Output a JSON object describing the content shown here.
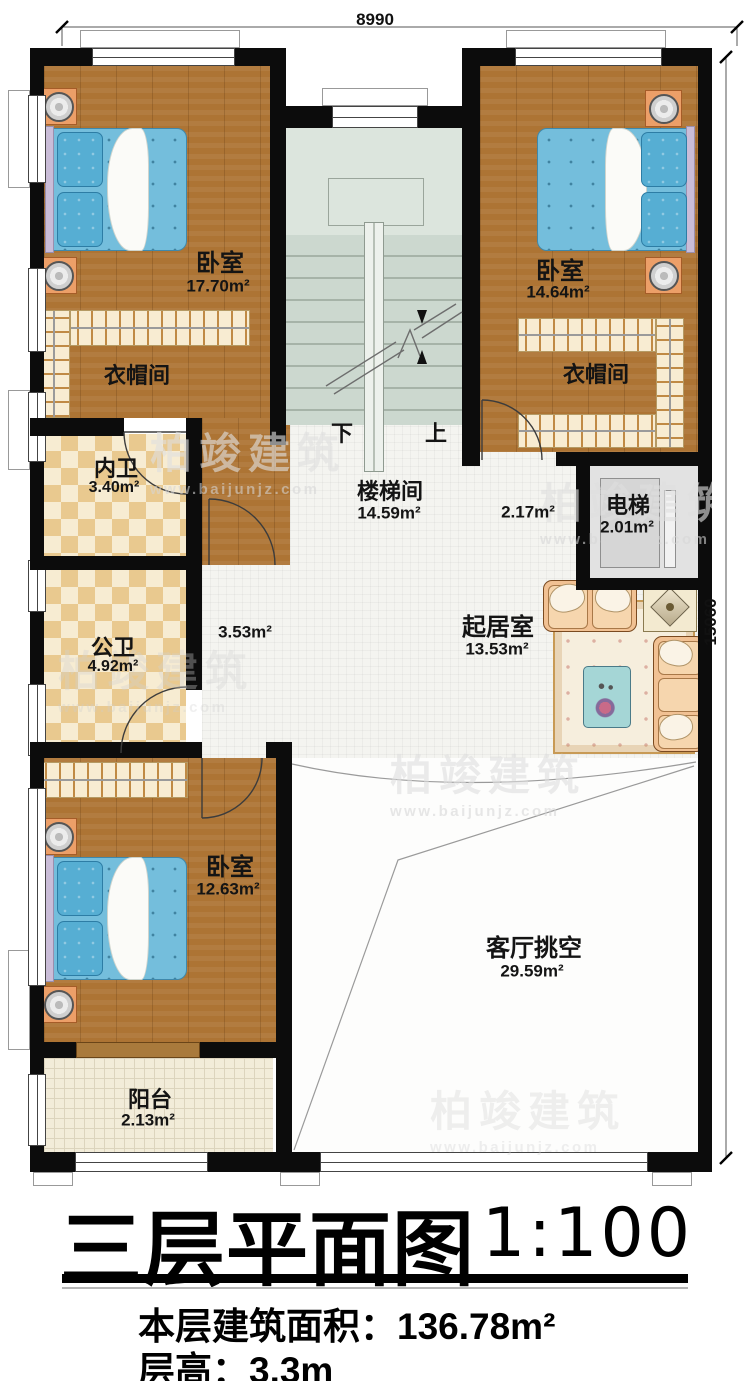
{
  "dimensions": {
    "top": "8990",
    "right": "15060"
  },
  "rooms": {
    "bedroom_tl": {
      "name": "卧室",
      "area": "17.70m²"
    },
    "bedroom_tr": {
      "name": "卧室",
      "area": "14.64m²"
    },
    "bedroom_b": {
      "name": "卧室",
      "area": "12.63m²"
    },
    "closet_l": {
      "name": "衣帽间"
    },
    "closet_r": {
      "name": "衣帽间"
    },
    "bath_inner": {
      "name": "内卫",
      "area": "3.40m²"
    },
    "bath_public": {
      "name": "公卫",
      "area": "4.92m²"
    },
    "stairwell": {
      "name": "楼梯间",
      "area": "14.59m²"
    },
    "elevator": {
      "name": "电梯",
      "area": "2.01m²"
    },
    "living": {
      "name": "起居室",
      "area": "13.53m²"
    },
    "hall_a": {
      "area": "2.17m²"
    },
    "hall_b": {
      "area": "3.53m²"
    },
    "void": {
      "name": "客厅挑空",
      "area": "29.59m²"
    },
    "balcony": {
      "name": "阳台",
      "area": "2.13m²"
    }
  },
  "stairs": {
    "down": "下",
    "up": "上"
  },
  "watermark": {
    "brand": "柏竣建筑",
    "url": "www.baijunjz.com"
  },
  "footer": {
    "title": "三层平面图",
    "scale": "1:100",
    "area_label": "本层建筑面积：",
    "area_value": "136.78m²",
    "height_label": "层高：",
    "height_value": "3.3m"
  },
  "colors": {
    "wall": "#0c0c0c",
    "wood_floor": "#ad7434",
    "tile_light": "#f7ecd2",
    "tile_dark": "#e9c98f",
    "stair_floor": "#ccd8cf",
    "bed_blue": "#74bedc",
    "nightstand_orange": "#ec9f68",
    "balcony_tile": "#f2ecd9",
    "sofa_tan": "#f1c193"
  }
}
